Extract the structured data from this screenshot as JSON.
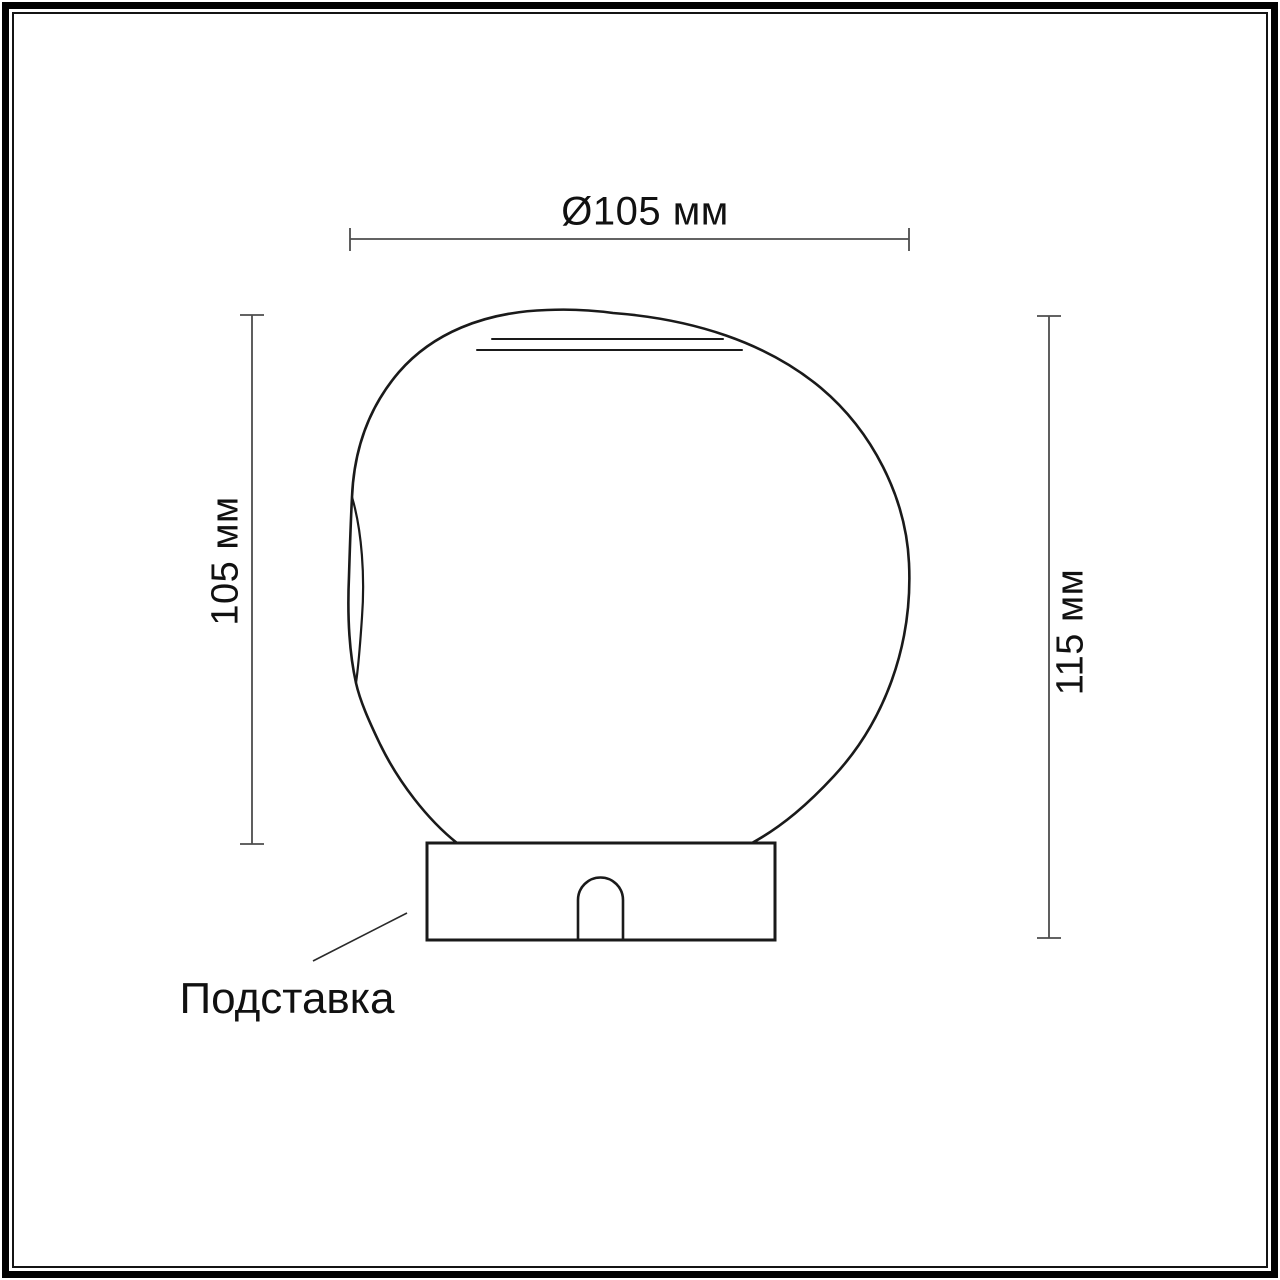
{
  "drawing": {
    "dimensions": {
      "diameter": "Ø105 мм",
      "shade_height": "105 мм",
      "total_height": "115 мм"
    },
    "annotations": {
      "base": "Подставка"
    },
    "colors": {
      "outline": "#1a1a1a",
      "dimension_line": "#4d4d4d",
      "text": "#111111",
      "background": "#ffffff"
    }
  }
}
